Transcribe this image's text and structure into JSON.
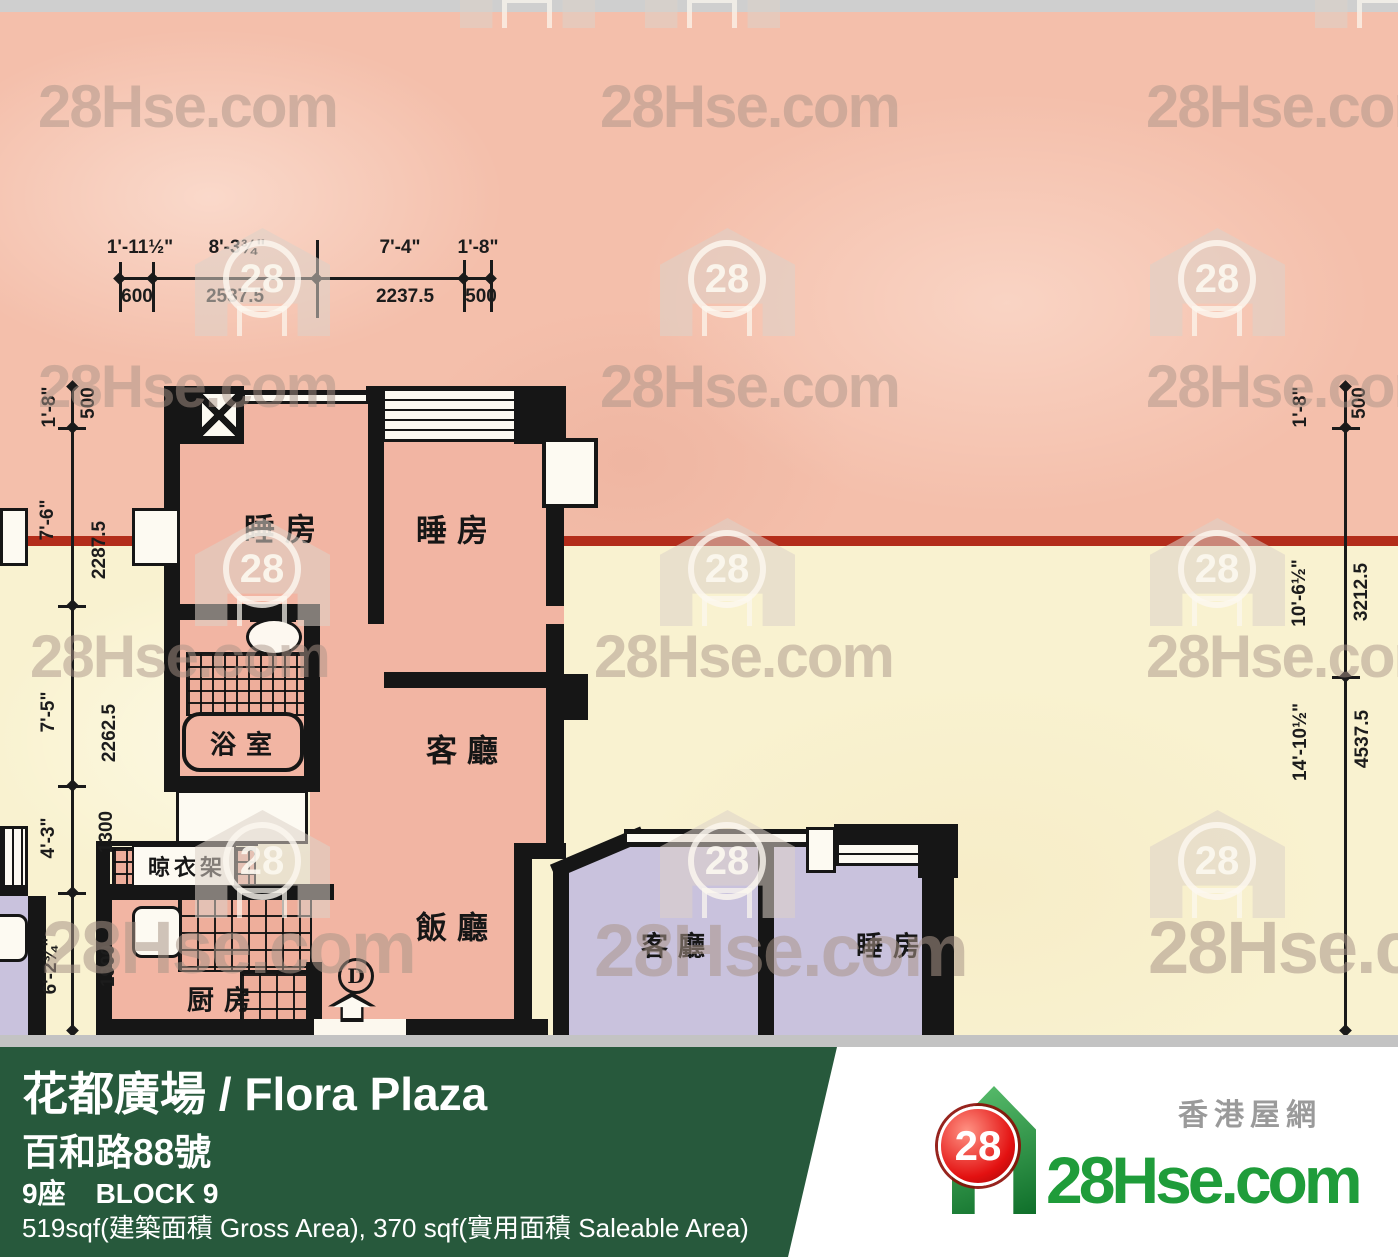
{
  "watermark": {
    "brand": "28Hse.com",
    "badge": "28"
  },
  "plan": {
    "dims_top": {
      "feet": [
        "1'-11½\"",
        "8'-3¾\"",
        "7'-4\"",
        "1'-8\""
      ],
      "mm": [
        "600",
        "2537.5",
        "2237.5",
        "500"
      ]
    },
    "dims_left": {
      "feet": [
        "1'-8\"",
        "7'-6\"",
        "7'-5\"",
        "4'-3\"",
        "6'-2¾\""
      ],
      "mm": [
        "500",
        "2287.5",
        "2262.5",
        "1300",
        "1900"
      ]
    },
    "dims_right": {
      "feet": [
        "1'-8\"",
        "10'-6½\"",
        "14'-10½\""
      ],
      "mm": [
        "500",
        "3212.5",
        "4537.5"
      ]
    },
    "rooms": {
      "bedroom_a": "睡房",
      "bedroom_b": "睡房",
      "bathroom": "浴室",
      "living": "客廳",
      "dining": "飯廳",
      "kitchen": "厨房",
      "drying": "晾衣架",
      "door": "D",
      "adj_living": "客廳",
      "adj_bedroom": "睡房"
    }
  },
  "footer": {
    "title": "花都廣場 / Flora Plaza",
    "address": "百和路88號",
    "block_cn": "9座",
    "block_en": "BLOCK 9",
    "area": "519sqf(建築面積 Gross Area), 370 sqf(實用面積 Saleable Area)",
    "brand": {
      "cn": "香港屋網",
      "name": "28Hse.com",
      "badge": "28"
    }
  },
  "colors": {
    "pink_bg": "#f4bfab",
    "cream_bg": "#f9f2d0",
    "unit_pink": "#f2b5a3",
    "lavender": "#c9c2dd",
    "boundary_red": "#b32d1a",
    "footer_green": "#27593c",
    "brand_green": "#1f9c3a",
    "wall_black": "#161616"
  }
}
